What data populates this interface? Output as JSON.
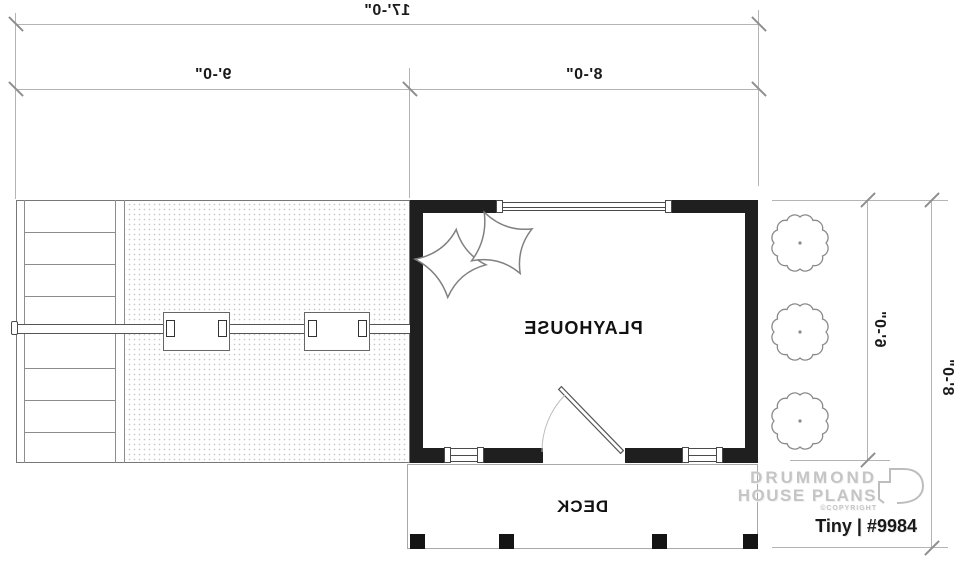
{
  "dims": {
    "total_width": "17'-0\"",
    "left_width": "9'-0\"",
    "right_width": "8'-0\"",
    "house_depth": "6'-0\"",
    "total_depth": "8'-0\""
  },
  "rooms": {
    "playhouse": "PLAYHOUSE",
    "deck": "DECK"
  },
  "branding": {
    "line1": "DRUMMOND",
    "line2": "HOUSE PLANS",
    "copyright": "©COPYRIGHT",
    "plan_id": "Tiny | #9984"
  },
  "colors": {
    "wall": "#1f1f1f",
    "dimension_line": "#b4b4b4",
    "logo_gray": "#c5c5c5",
    "ink": "#1a1a1a"
  }
}
